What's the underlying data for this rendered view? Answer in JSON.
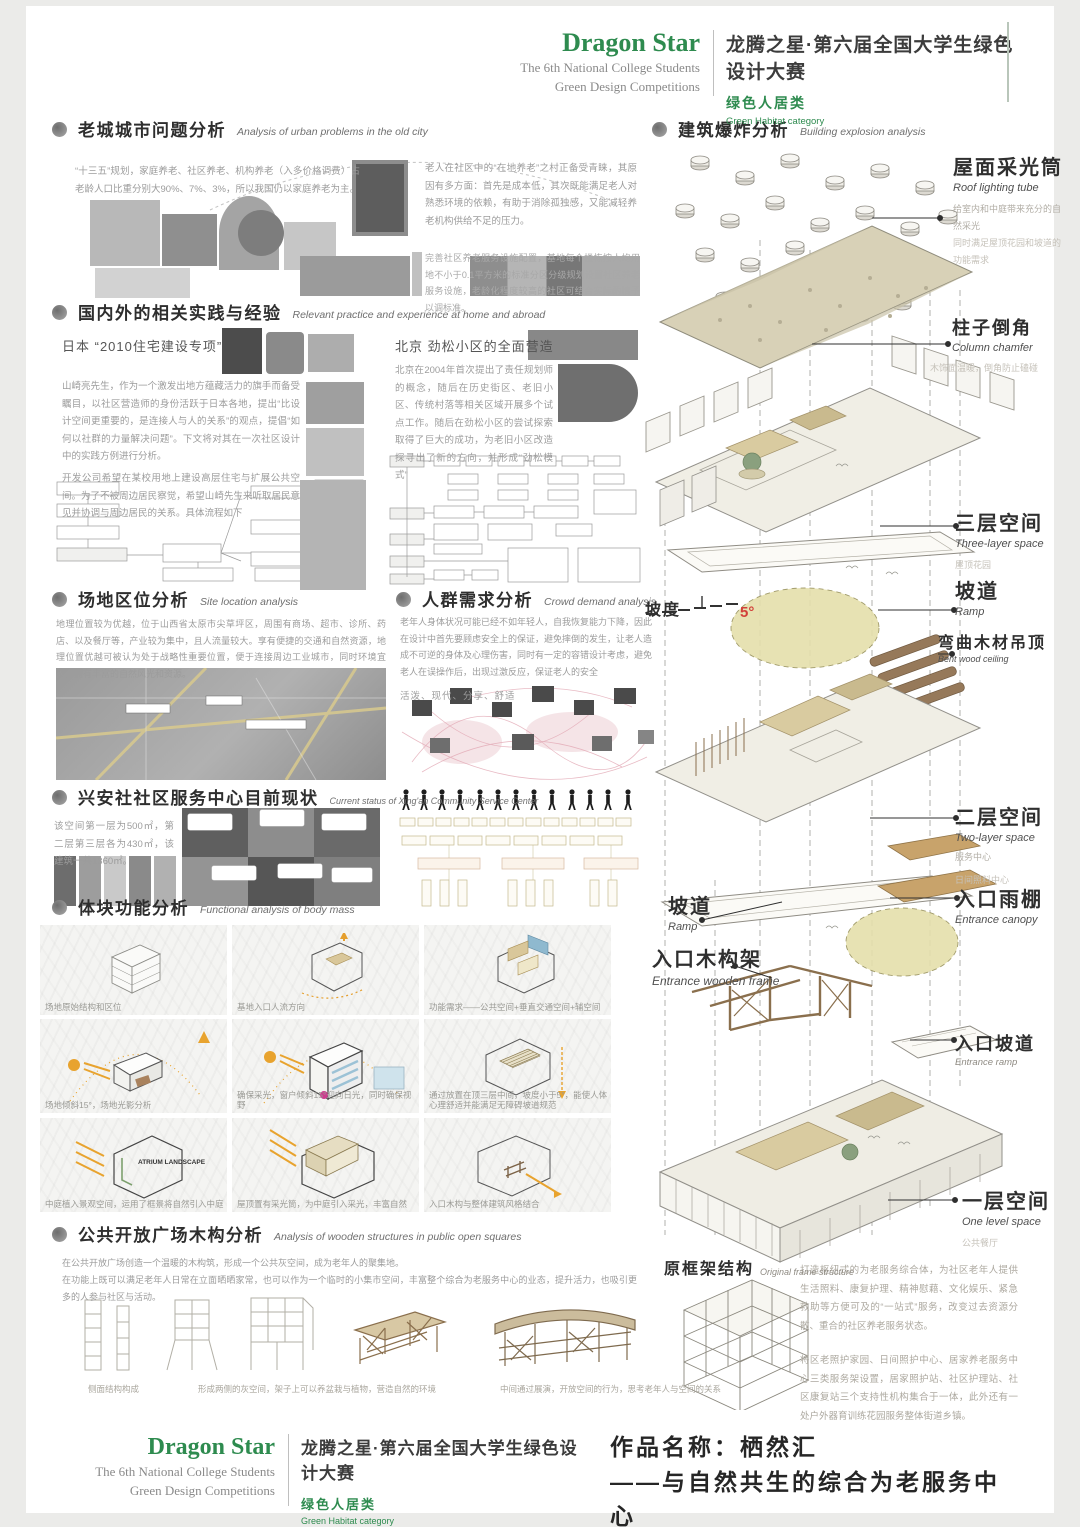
{
  "brand": {
    "name": "Dragon Star",
    "subtitle_line1": "The 6th National College Students",
    "subtitle_line2": "Green Design Competitions",
    "title_cn": "龙腾之星·第六届全国大学生绿色设计大赛",
    "category_cn": "绿色人居类",
    "category_en": "Green Habitat category"
  },
  "sections": {
    "urban": {
      "title_cn": "老城城市问题分析",
      "title_en": "Analysis of urban problems in the old city",
      "para_left": "“十三五”规划，家庭养老、社区养老、机构养老（入多价格调费）占老龄人口比重分别大90%、7%、3%，所以我国仍以家庭养老为主。",
      "para_right": "老人在社区中的“在地养老”之村正备受青睐，其原因有多方面：首先是成本低，其次既能满足老人对熟悉环境的依赖，有助于消除孤独感，又能减轻养老机构供给不足的压力。",
      "para_note": "完善社区养老服务设施配置，基地每个楼栋按人均用地不小于0.1平方米的标准分区分级规划设置社区养老服务设施，老龄化程度较高的社区可结合实际酌情予以调标准。"
    },
    "practice": {
      "title_cn": "国内外的相关实践与经验",
      "title_en": "Relevant practice and experience at home and abroad",
      "japan_title": "日本 “2010住宅建设专项”",
      "japan_para": "山崎亮先生，作为一个激发出地方蕴藏活力的旗手而备受瞩目，以社区营造师的身份活跃于日本各地，提出“比设计空间更重要的，是连接人与人的关系”的观点，提倡“如何以社群的力量解决问题”。下文将对其在一次社区设计中的实践方例进行分析。",
      "japan_para2": "开发公司希望在某校用地上建设高层住宅与扩展公共空间。为了不被周边居民察觉，希望山崎先生来听取居民意见并协调与周边居民的关系。具体流程如下",
      "beijing_title": "北京 劲松小区的全面营造",
      "beijing_para": "北京在2004年首次提出了责任规划师的概念，随后在历史街区、老旧小区、传统村落等相关区域开展多个试点工作。随后在劲松小区的尝试探索取得了巨大的成功，为老旧小区改造探寻出了新的方向，并形成“劲松模式”"
    },
    "site": {
      "title_cn": "场地区位分析",
      "title_en": "Site location analysis",
      "para": "地理位置较为优越，位于山西省太原市尖草坪区，周围有商场、超市、诊所、药店、以及餐厅等，产业较为集中，且人流量较大。享有便捷的交通和自然资源，地理位置优越可被认为处于战略性重要位置，便于连接周边工业城市，同时环境宜人，拥有丰富的自然风光和资源。"
    },
    "crowd": {
      "title_cn": "人群需求分析",
      "title_en": "Crowd demand analysis",
      "para": "老年人身体状况可能已经不如年轻人，自我恢复能力下降，因此在设计中首先要顾虑安全上的保证，避免摔倒的发生，让老人造成不可逆的身体及心理伤害，同时有一定的容错设计考虑，避免老人在误操作后，出现过激反应，保证老人的安全",
      "keywords": "活泼、现代、分享、舒适"
    },
    "status": {
      "title_cn": "兴安社社区服务中心目前现状",
      "title_en": "Current status of Xing'an Community Service Center",
      "para": "该空间第一层为500㎡，第二层第三层各为430㎡，该建筑一共1360㎡。"
    },
    "mass": {
      "title_cn": "体块功能分析",
      "title_en": "Functional analysis of body mass",
      "captions": [
        "场地原始结构和区位",
        "基地入口人流方向",
        "功能需求——公共空间+垂直交通空间+辅空间",
        "场地倾斜15°，场地光影分析",
        "确保采光，窗户倾斜15°迎向日光，同时确保视野",
        "通过放置在顶三层中间，坡度小于5°，能使人体心理舒适并能满足无障碍坡道规范",
        "中庭植入景观空间，运用了框景将自然引入中庭",
        "屋顶置有采光筒，为中庭引入采光，丰富自然",
        "入口木构与整体建筑风格结合"
      ],
      "atrium_label": "ATRIUM LANDSCAPE"
    },
    "plaza": {
      "title_cn": "公共开放广场木构分析",
      "title_en": "Analysis of wooden structures in public open squares",
      "para1": "在公共开放广场创造一个温暖的木构筑，形成一个公共灰空间，成为老年人的聚集地。",
      "para2": "在功能上既可以满足老年人日常在立面晒晒家常，也可以作为一个临时的小集市空间，丰富整个综合为老服务中心的业态，提升活力，也吸引更多的人参与社区与活动。",
      "captions": [
        "侧面结构构成",
        "形成两侧的灰空间，架子上可以养盆栽与植物，营造自然的环境",
        "中间通过展演，开放空间的行为，思考老年人与空间的关系"
      ]
    },
    "explosion": {
      "title_cn": "建筑爆炸分析",
      "title_en": "Building explosion analysis",
      "slope_label": "坡度",
      "slope_value": "5°",
      "labels": [
        {
          "cn": "屋面采光筒",
          "en": "Roof lighting tube",
          "n1": "给室内和中庭带来充分的自然采光",
          "n2": "同时满足屋顶花园和坡道的功能需求"
        },
        {
          "cn": "柱子倒角",
          "en": "Column chamfer",
          "n1": "木饰面温暖，倒角防止磕碰"
        },
        {
          "cn": "三层空间",
          "en": "Three-layer space",
          "n1": "屋顶花园"
        },
        {
          "cn": "坡道",
          "en": "Ramp"
        },
        {
          "cn": "弯曲木材吊顶",
          "en": "Bent wood ceiling"
        },
        {
          "cn": "二层空间",
          "en": "Two-layer space",
          "n1": "服务中心",
          "n2": "日间照料中心"
        },
        {
          "cn": "入口雨棚",
          "en": "Entrance canopy"
        },
        {
          "cn": "坡道",
          "en": "Ramp"
        },
        {
          "cn": "入口木构架",
          "en": "Entrance wooden frame"
        },
        {
          "cn": "入口坡道",
          "en": "Entrance ramp"
        },
        {
          "cn": "一层空间",
          "en": "One level space",
          "n1": "公共餐厅"
        },
        {
          "cn": "原框架结构",
          "en": "Original frame structure"
        }
      ],
      "para1": "打造枢纽式的为老服务综合体，为社区老年人提供生活照料、康复护理、精神慰藉、文化娱乐、紧急救助等方便可及的“一站式”服务，改变过去资源分散、重合的社区养老服务状态。",
      "para2": "将区老照护家园、日间照护中心、居家养老服务中心三类服务架设置，居家照护站、社区护理站、社区康复站三个支持性机构集合于一体，此外还有一处户外器育训练花园服务整体街道乡镇。"
    }
  },
  "footer": {
    "work_line1": "作品名称：栖然汇",
    "work_line2": "——与自然共生的综合为老服务中心",
    "name_of_work": "Name of Work:"
  }
}
